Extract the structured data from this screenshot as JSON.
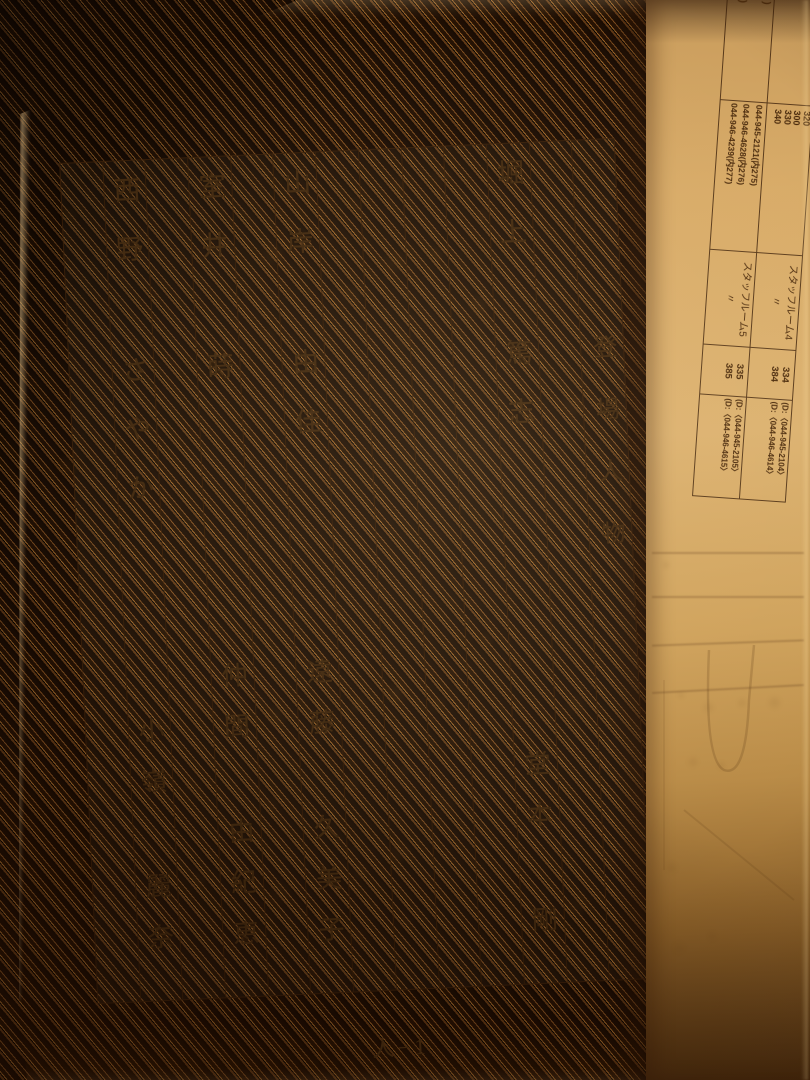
{
  "main_page": {
    "title": "登場人物",
    "page_label": "人−1",
    "cast": [
      {
        "role": "堀上 篤志",
        "actor": "堂本 剛"
      },
      {
        "role": "山岸 由佳",
        "actor": "遠藤 久美子"
      },
      {
        "role": "室井 蒔",
        "actor": "仲間 由紀恵"
      },
      {
        "role": "西野 さやか",
        "actor": "小嶺 麗奈"
      }
    ]
  },
  "side_page": {
    "rows": [
      {
        "cells": [
          {
            "name": "rooms",
            "lines": [
              "予備控室B",
              "パントリー",
              "特別会議室",
              "特別控室",
              "NTV分室"
            ]
          },
          {
            "name": "room-extensions",
            "lines": [
              "320",
              "300",
              "330",
              "340"
            ]
          },
          {
            "name": "staff-room",
            "lines": [
              "スタッフルーム4",
              "〃"
            ]
          },
          {
            "name": "staff-extensions",
            "lines": [
              "334",
              "384"
            ]
          },
          {
            "name": "direct-numbers",
            "lines": [
              "(D:〈044-945-2104〉",
              "(D:〈044-946-4614〉"
            ]
          }
        ]
      },
      {
        "cells": [
          {
            "name": "fax-label",
            "lines": [
              "FAX (1F)",
              "・",
              "FAX (4F)"
            ]
          },
          {
            "name": "fax-numbers",
            "lines": [
              "044-945-2121(内275)",
              "044-946-4628(内276)",
              "044-946-4239(内277)"
            ]
          },
          {
            "name": "staff-room",
            "lines": [
              "スタッフルーム5",
              "〃"
            ]
          },
          {
            "name": "staff-extensions",
            "lines": [
              "335",
              "385"
            ]
          },
          {
            "name": "direct-numbers",
            "lines": [
              "(D:〈044-945-2105〉",
              "(D:〈044-946-4615〉"
            ]
          }
        ]
      }
    ]
  },
  "colors": {
    "paper": "#dcaa65",
    "ink": "#40280f",
    "mat": "#2a1507"
  }
}
